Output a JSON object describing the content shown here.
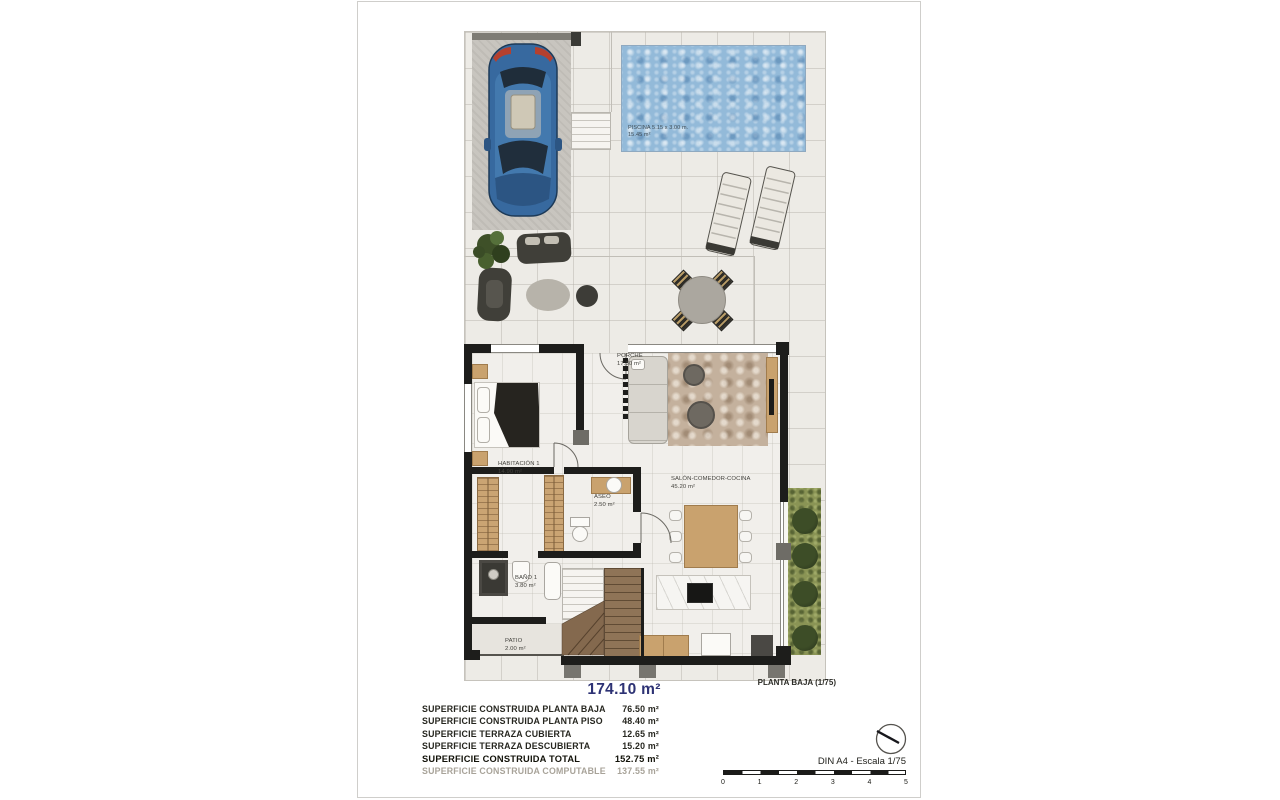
{
  "plan": {
    "title": "PLANTA BAJA (1/75)",
    "rooms": {
      "piscina": {
        "name": "PISCINA 5.15 x 3.00 m.",
        "area": "15.45 m²"
      },
      "porche": {
        "name": "PORCHE",
        "area": "17.30 m²"
      },
      "habitacion1": {
        "name": "HABITACIÓN 1",
        "area": "14.90 m²"
      },
      "aseo": {
        "name": "ASEO",
        "area": "2.50 m²"
      },
      "salon": {
        "name": "SALÓN-COMEDOR-COCINA",
        "area": "45.20 m²"
      },
      "bano1": {
        "name": "BAÑO 1",
        "area": "3.80 m²"
      },
      "patio": {
        "name": "PATIO",
        "area": "2.00 m²"
      }
    }
  },
  "summary": {
    "headline_area": "174.10 m²",
    "rows": [
      {
        "label": "SUPERFICIE CONSTRUIDA PLANTA BAJA",
        "value": "76.50 m²"
      },
      {
        "label": "SUPERFICIE CONSTRUIDA PLANTA PISO",
        "value": "48.40 m²"
      },
      {
        "label": "SUPERFICIE TERRAZA CUBIERTA",
        "value": "12.65 m²"
      },
      {
        "label": "SUPERFICIE TERRAZA DESCUBIERTA",
        "value": "15.20 m²"
      },
      {
        "label": "SUPERFICIE CONSTRUIDA TOTAL",
        "value": "152.75 m²"
      },
      {
        "label": "SUPERFICIE CONSTRUIDA COMPUTABLE",
        "value": "137.55 m²"
      }
    ]
  },
  "footer": {
    "scale_note": "DIN A4 - Escala 1/75",
    "scale_ticks": [
      "0",
      "1",
      "2",
      "3",
      "4",
      "5"
    ]
  },
  "colors": {
    "headline": "#2d3274",
    "text": "#26261f",
    "muted": "#a8a399",
    "wall": "#1d1d1b",
    "pool_water": "#93bad9",
    "wood": "#c9a26e",
    "grass": "#8a9455",
    "car_body": "#37699f"
  }
}
